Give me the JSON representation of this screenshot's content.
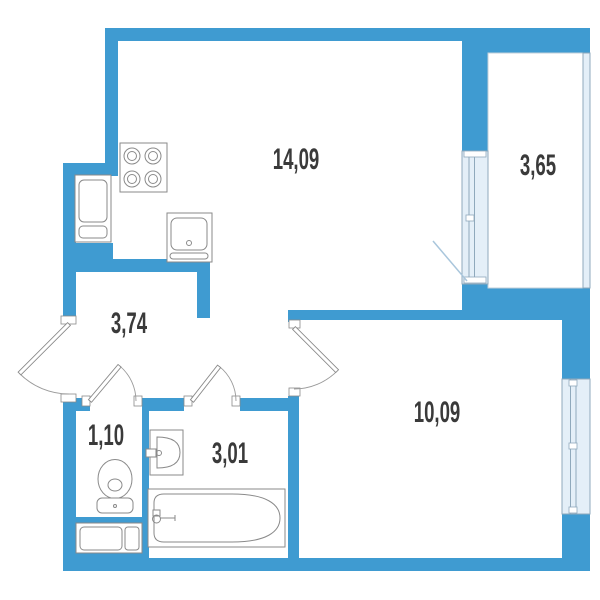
{
  "plan_title": "apartment-floor-plan",
  "rooms": [
    {
      "key": "kitchen_living",
      "label": "14,09"
    },
    {
      "key": "balcony",
      "label": "3,65"
    },
    {
      "key": "hallway",
      "label": "3,74"
    },
    {
      "key": "wc",
      "label": "1,10"
    },
    {
      "key": "bathroom",
      "label": "3,01"
    },
    {
      "key": "room",
      "label": "10,09"
    }
  ],
  "colors": {
    "bg": "#FFFFFF",
    "wall": "#3F9BD1",
    "window": "#E4EFF8",
    "window_frame": "#8FA9BC",
    "fixture": "#8A8A8A",
    "arc": "#9A9A9A",
    "label": "#3A3A3A",
    "balcony_leaf": "#A9C6DC"
  },
  "icons": [
    "stove-icon",
    "fridge-icon",
    "kitchen-sink-icon",
    "toilet-icon",
    "washbasin-icon",
    "bathtub-icon",
    "vent-shaft-icon",
    "door-swing-icon",
    "window-icon"
  ]
}
